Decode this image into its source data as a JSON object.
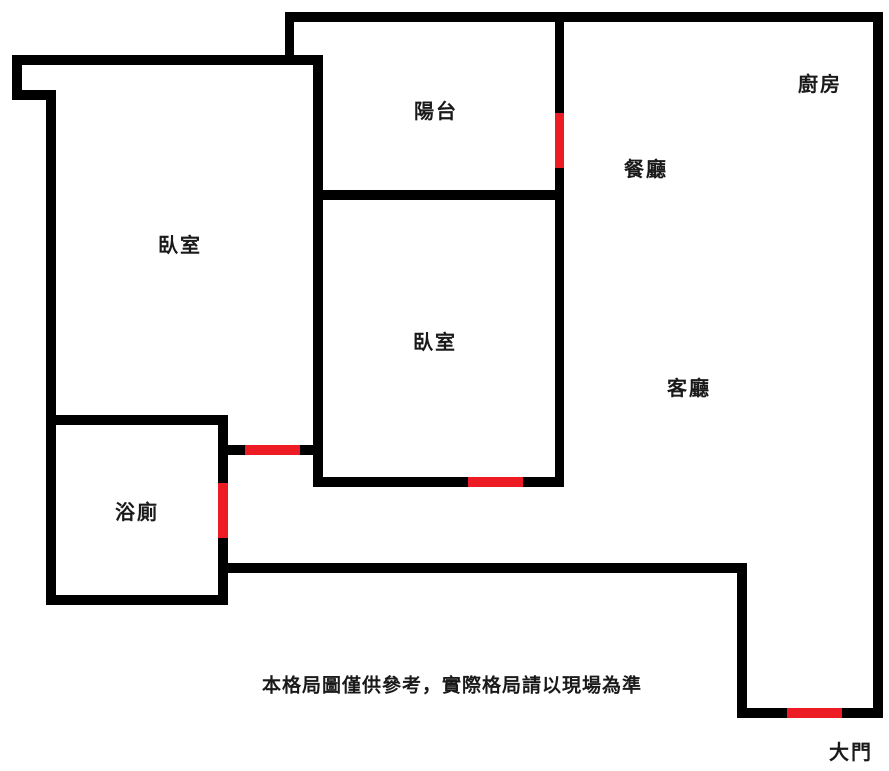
{
  "colors": {
    "background": "#ffffff",
    "wall": "#000000",
    "door": "#ed1c24",
    "text": "#1a1a1a"
  },
  "rooms": {
    "balcony": {
      "label": "陽台"
    },
    "kitchen": {
      "label": "廚房"
    },
    "dining": {
      "label": "餐廳"
    },
    "bedroom_left": {
      "label": "臥室"
    },
    "bedroom_middle": {
      "label": "臥室"
    },
    "living": {
      "label": "客廳"
    },
    "bathroom": {
      "label": "浴廁"
    },
    "main_entrance": {
      "label": "大門"
    }
  },
  "doors": [
    "door-balcony",
    "door-bedroom-left",
    "door-bathroom",
    "door-bedroom-middle",
    "door-main-entrance"
  ],
  "disclaimer": "本格局圖僅供參考，實際格局請以現場為準"
}
